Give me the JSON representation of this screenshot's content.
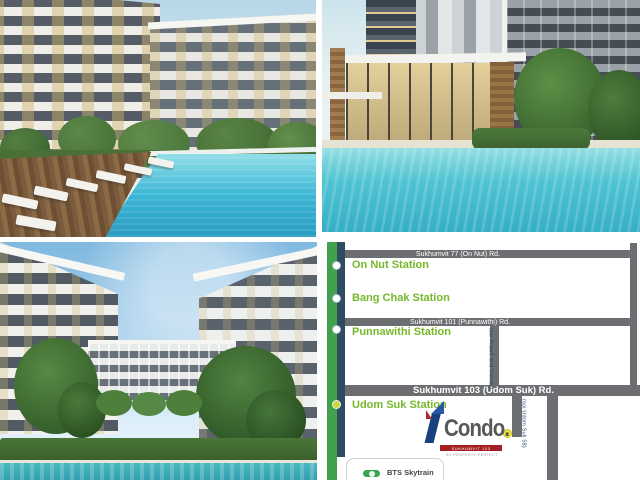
{
  "map": {
    "roads": {
      "sukhumvit77": "Sukhumvit 77 (On Nut) Rd.",
      "sukhumvit101": "Sukhumvit 101 (Punnawithi) Rd.",
      "sukhumvit103": "Sukhumvit 103 (Udom Suk) Rd.",
      "soi_prawit": "(soi Prawit and friends)",
      "soi_udom_suk_58": "(soi Udom Suk 58)"
    },
    "stations": [
      {
        "label": "On Nut Station"
      },
      {
        "label": "Bang Chak Station"
      },
      {
        "label": "Punnawithi Station"
      },
      {
        "label": "Udom Suk Station"
      }
    ],
    "legend": {
      "bts": "BTS Skytrain"
    },
    "logo": {
      "brand": "Condo.",
      "banner": "SUKHUMVIT 103",
      "tagline": "BY PROPERTY PERFECT"
    },
    "colors": {
      "bts_line_green": "#42a04e",
      "bts_stripe_navy": "#2e4d63",
      "road_gray": "#6d6e71",
      "station_text_green": "#76b82a",
      "soi_text_blue": "#27477f",
      "location_dot_yellow": "#ede73a",
      "logo_blue": "#1f4e9c",
      "logo_red": "#a51e22",
      "pool_turquoise": "#3cb6d6"
    }
  }
}
